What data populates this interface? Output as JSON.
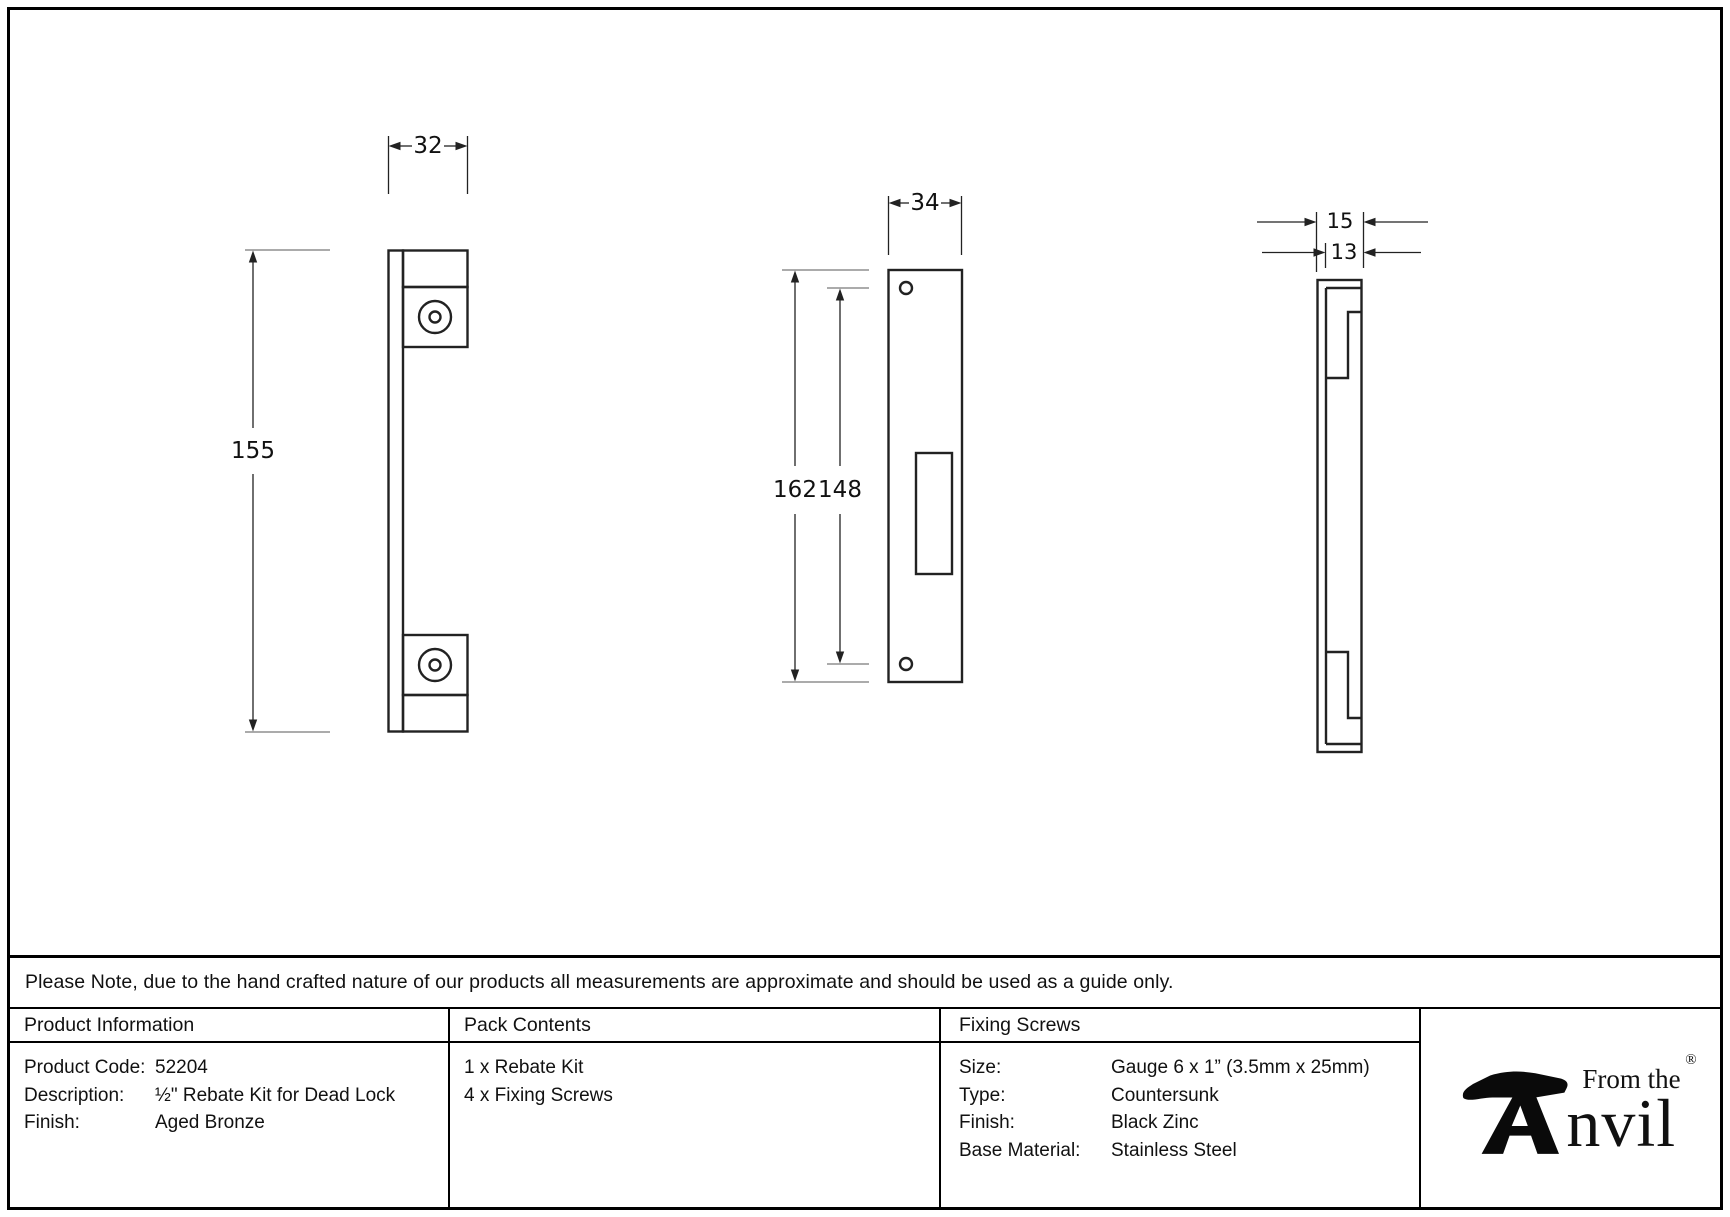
{
  "note": "Please Note, due to the hand crafted nature of our products all measurements are approximate and should be used as a guide only.",
  "drawings": {
    "left_view": {
      "width_label": "32",
      "height_label": "155"
    },
    "front_view": {
      "width_label": "34",
      "height_label": "162",
      "hole_spacing_label": "148"
    },
    "side_view": {
      "thickness_label": "15",
      "inner_thickness_label": "13"
    }
  },
  "product_info": {
    "title": "Product Information",
    "rows": [
      {
        "label": "Product Code:",
        "value": "52204"
      },
      {
        "label": "Description:",
        "value": "½\" Rebate Kit for Dead Lock"
      },
      {
        "label": "Finish:",
        "value": "Aged Bronze"
      }
    ]
  },
  "pack_contents": {
    "title": "Pack Contents",
    "items": [
      "1 x Rebate Kit",
      "4 x Fixing Screws"
    ]
  },
  "fixing_screws": {
    "title": "Fixing Screws",
    "rows": [
      {
        "label": "Size:",
        "value": "Gauge 6 x 1” (3.5mm x 25mm)"
      },
      {
        "label": "Type:",
        "value": "Countersunk"
      },
      {
        "label": "Finish:",
        "value": "Black Zinc"
      },
      {
        "label": "Base Material:",
        "value": "Stainless Steel"
      }
    ]
  },
  "logo": {
    "tagline": "From the",
    "wordmark": "nvil",
    "registered": "®"
  }
}
